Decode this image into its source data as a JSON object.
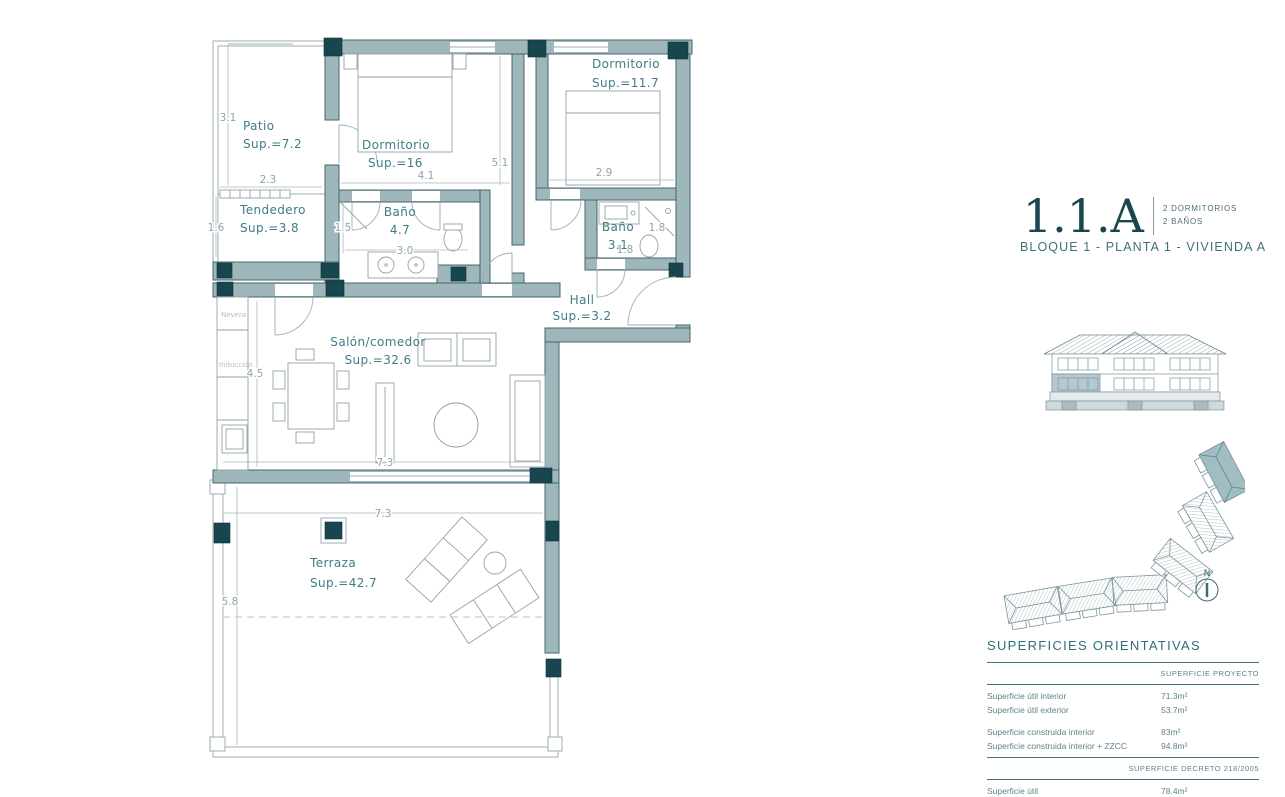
{
  "title_block": {
    "unit": "1.1.A",
    "feature_1": "2 DORMITORIOS",
    "feature_2": "2 BAÑOS",
    "subtitle": "BLOQUE 1 - PLANTA 1 - VIVIENDA A"
  },
  "floorplan": {
    "rooms": {
      "patio": {
        "name": "Patio",
        "sup": "Sup.=7.2"
      },
      "tendedero": {
        "name": "Tendedero",
        "sup": "Sup.=3.8"
      },
      "dorm1": {
        "name": "Dormitorio",
        "sup": "Sup.=16"
      },
      "dorm2": {
        "name": "Dormitorio",
        "sup": "Sup.=11.7"
      },
      "bano1": {
        "name": "Baño",
        "sup": "4.7"
      },
      "bano2": {
        "name": "Baño",
        "sup": "3.1"
      },
      "hall": {
        "name": "Hall",
        "sup": "Sup.=3.2"
      },
      "salon": {
        "name": "Salón/comedor",
        "sup": "Sup.=32.6"
      },
      "terraza": {
        "name": "Terraza",
        "sup": "Sup.=42.7"
      }
    },
    "kitchen": {
      "fridge": "Nevera",
      "hob": "Inducción"
    },
    "dims": {
      "patio_height": "3.1",
      "patio_width": "2.3",
      "tendedero_height": "1.6",
      "dorm1_width": "4.1",
      "pasillo_height": "5.1",
      "dorm2_width": "2.9",
      "bano1_height": "1.5",
      "bano1_width": "3.0",
      "bano2_width": "1.8",
      "bano2_height": "1.8",
      "salon_height": "4.5",
      "salon_width": "7.3",
      "terraza_width": "7.3",
      "terraza_height": "5.8"
    }
  },
  "siteplan": {
    "north_label": "N"
  },
  "surfaces": {
    "title": "SUPERFICIES ORIENTATIVAS",
    "project": {
      "header": "SUPERFICIE PROYECTO",
      "rows": [
        {
          "label": "Superficie útil interior",
          "value": "71.3m²"
        },
        {
          "label": "Superficie útil exterior",
          "value": "53.7m²"
        },
        {
          "label": "Superficie construida interior",
          "value": "83m²"
        },
        {
          "label": "Superficie construida interior + ZZCC",
          "value": "94.8m²"
        }
      ]
    },
    "decree": {
      "header": "SUPERFICIE DECRETO 218/2005",
      "rows": [
        {
          "label": "Superficie útil",
          "value": "78.4m²"
        },
        {
          "label": "Superficie construida",
          "value": "104.3m²"
        }
      ]
    }
  },
  "colors": {
    "accent": "#1a474f",
    "wall": "#9db7bb",
    "column": "#17464f",
    "room_text": "#3f7d86"
  }
}
